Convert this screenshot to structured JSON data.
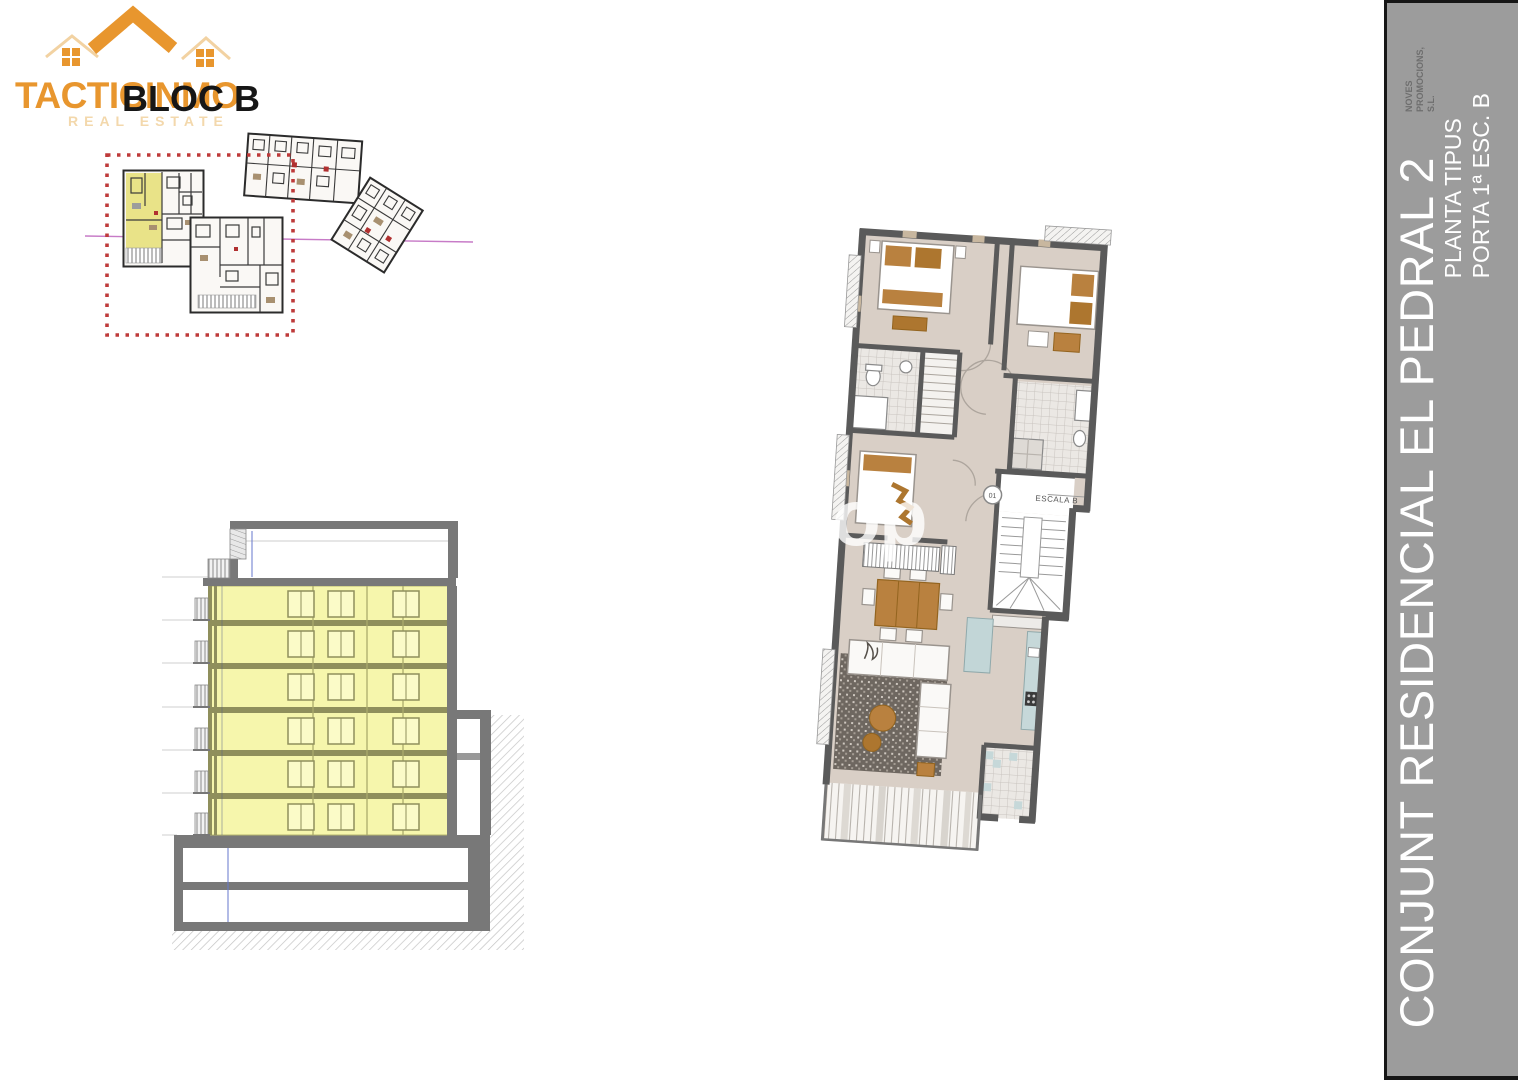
{
  "logo": {
    "brand": "TACTICINMO",
    "overlay": "BLOC B",
    "tagline": "REAL ESTATE"
  },
  "sidebar": {
    "project_title": "CONJUNT RESIDENCIAL EL PEDRAL 2",
    "plan_type": "PLANTA TIPUS",
    "unit": "PORTA 1ª ESC. B",
    "developer_line1": "NOVES",
    "developer_line2": "PROMOCIONS,",
    "developer_line3": "S.L."
  },
  "floor_plan": {
    "stair_label": "ESCALA B",
    "door_number": "01"
  },
  "watermark": "op",
  "colors": {
    "logo_orange": "#E8962E",
    "logo_tagline": "#F3D8AC",
    "sidebar_gray": "#9C9C9C",
    "sidebar_text": "#FFFFFF",
    "developer_text": "#6E6E6E",
    "highlight_yellow": "#F6F6AC",
    "siteplan_yellow": "#E9E388",
    "selection_red": "#BE3A3A",
    "axis_magenta": "#C77BC7",
    "wall_gray": "#5A5A5A",
    "floor_beige": "#D9CFC6",
    "kitchen_blue": "#C6D8D9",
    "furniture_brown": "#B9813F",
    "dimension_blue": "#6677CC"
  }
}
